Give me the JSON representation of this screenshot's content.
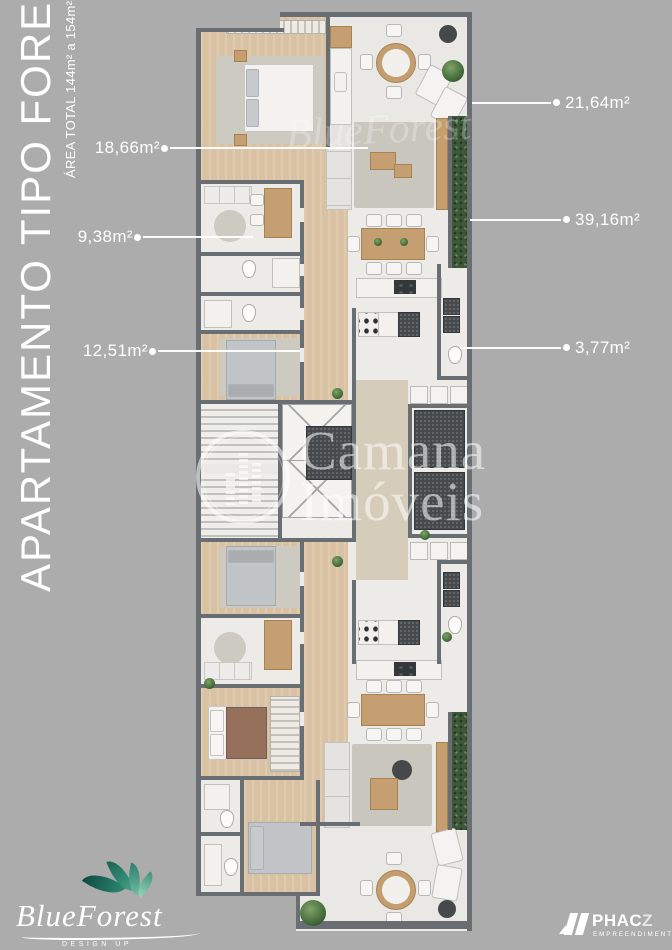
{
  "page": {
    "background_color": "#ACACAC"
  },
  "sidebar": {
    "title": "APARTAMENTO TIPO FOREST",
    "subtitle": "ÁREA TOTAL 144m² a 154m²"
  },
  "area_labels": {
    "left": [
      "18,66m²",
      "9,38m²",
      "12,51m²"
    ],
    "right": [
      "21,64m²",
      "39,16m²",
      "3,77m²"
    ]
  },
  "watermarks": {
    "agency_line1": "Camana",
    "agency_line2": "Imóveis",
    "script_brand": "BlueForest"
  },
  "logos": {
    "blueforest": {
      "name": "BlueForest",
      "tagline": "DESIGN UP"
    },
    "phacz": {
      "name_main": "PHAC",
      "name_accent": "Z",
      "tagline": "EMPREENDIMENTOS"
    }
  },
  "colors": {
    "wall": "#696E72",
    "floor": "#ECEBE8",
    "wood": "#D8C2A3",
    "hedge_green": "#3D5839",
    "hall_beige": "#D6CCBA",
    "brand_teal": "#2E8A72",
    "label_text": "#FFFFFF"
  }
}
